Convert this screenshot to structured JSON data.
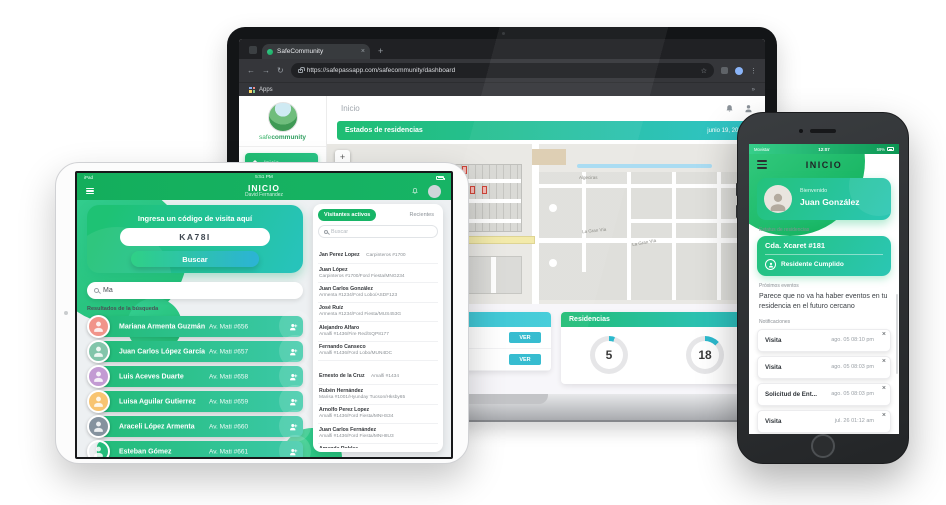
{
  "icons": {
    "back": "←",
    "forward": "→",
    "reload": "↻",
    "star": "☆",
    "more": "⋮",
    "close": "×",
    "new_tab": "+",
    "zoom_in": "+",
    "zoom_out": "−",
    "overflow": "»"
  },
  "laptop": {
    "browser": {
      "tab_title": "SafeCommunity",
      "url": "https://safepassapp.com/safecommunity/dashboard",
      "bookmarks_label": "Apps"
    },
    "app": {
      "logo": {
        "part1": "safe",
        "part2": "community"
      },
      "nav": [
        {
          "label": "Inicio",
          "active": true
        },
        {
          "label": "Calendario"
        }
      ],
      "page_title": "Inicio",
      "banner": {
        "title": "Estados de residencias",
        "date": "junio 19, 2019"
      },
      "map": {
        "avenue": "Avenida Canal Coco",
        "street1": "Algeciras",
        "street2": "La Gran Vía",
        "street3": "La Gran Vía"
      },
      "recientes": {
        "title": "Recientes",
        "rows": [
          {
            "action": "VER"
          },
          {
            "action": "VER"
          }
        ]
      },
      "residencias": {
        "title": "Residencias",
        "stats": [
          {
            "value": "5",
            "percent": 5
          },
          {
            "value": "18",
            "percent": 13
          }
        ]
      }
    }
  },
  "tablet": {
    "status_bar": {
      "left": "iPad",
      "time": "5:51 PM"
    },
    "header": {
      "title": "INICIO",
      "subtitle": "David Fernandez"
    },
    "code_card": {
      "prompt": "Ingresa un código de visita aquí",
      "code": "KA78I",
      "button": "Buscar"
    },
    "search": {
      "value": "Ma"
    },
    "results_label": "Resultados de la búsqueda",
    "results": [
      {
        "name": "Mariana Armenta Guzmán",
        "address": "Av. Mati #656"
      },
      {
        "name": "Juan Carlos López García",
        "address": "Av. Mati #657"
      },
      {
        "name": "Luis Aceves Duarte",
        "address": "Av. Mati #658"
      },
      {
        "name": "Luisa Aguilar Gutierrez",
        "address": "Av. Mati #659"
      },
      {
        "name": "Araceli López Armenta",
        "address": "Av. Mati #660"
      },
      {
        "name": "Esteban Gómez",
        "address": "Av. Mati #661"
      }
    ],
    "visitors_panel": {
      "tabs": [
        {
          "label": "Visitantes activos",
          "active": true
        },
        {
          "label": "Recientes"
        }
      ],
      "search_placeholder": "Buscar",
      "visitors": [
        {
          "name": "Jan Perez Lopez",
          "detail": "Carpinteros #1700",
          "inline": true
        },
        {
          "name": "Juan López",
          "detail": "Carpinteros #1700/Ford Fiesta/MNG234"
        },
        {
          "name": "Juan Carlos González",
          "detail": "Armenta #1234/Ford Lobo/ASDF123"
        },
        {
          "name": "José Ruíz",
          "detail": "Armenta #1234/Ford Fiesta/MUS453G"
        },
        {
          "name": "Alejandro Alfaro",
          "detail": "Amalfi #1436/Fire Red/SQP8177"
        },
        {
          "name": "Fernando Canseco",
          "detail": "Amalfi #1436/Ford Lobo/MUN4DC"
        },
        {
          "name": "Ernesto de la Cruz",
          "detail": "Amalfi #1434",
          "inline": true
        },
        {
          "name": "Rubén Hernández",
          "detail": "Marisa #1001/Hyunday Tucson/Hksby65"
        },
        {
          "name": "Arnolfo Perez Lopez",
          "detail": "Amalfi #1436/Ford Fiesta/MNHS34"
        },
        {
          "name": "Juan Carlos Fernández",
          "detail": "Amalfi #1436/Ford Fiesta/MNH8U3"
        },
        {
          "name": "Amanda Robles",
          "detail": "Livorno #1125/Nuevo Nuevo/NUEVECUTO"
        },
        {
          "name": "Fernanda Zárate",
          "detail": "Livorno #1125/Hyunday Tucson/Hksby65"
        }
      ]
    }
  },
  "phone": {
    "status_bar": {
      "carrier": "Movistar",
      "time": "12:07",
      "battery": "59%"
    },
    "header": {
      "title": "INICIO"
    },
    "welcome": {
      "greeting": "Bienvenido",
      "name": "Juan González"
    },
    "residence_label": "Estatus de residencias",
    "residence": {
      "address": "Cda. Xcaret #181",
      "status": "Residente Cumplido"
    },
    "events_label": "Próximos eventos",
    "events_empty": "Parece que no va ha haber eventos en tu residencia en el futuro cercano",
    "notifications_label": "Notificaciones",
    "notifications": [
      {
        "title": "Visita",
        "date": "ago. 05 08:10 pm"
      },
      {
        "title": "Visita",
        "date": "ago. 05 08:03 pm"
      },
      {
        "title": "Solicitud de Ent...",
        "date": "ago. 05 08:03 pm"
      },
      {
        "title": "Visita",
        "date": "jul. 26 01:12 am"
      },
      {
        "title": "Visita",
        "date": "jul. 26 01:12 am"
      }
    ]
  }
}
